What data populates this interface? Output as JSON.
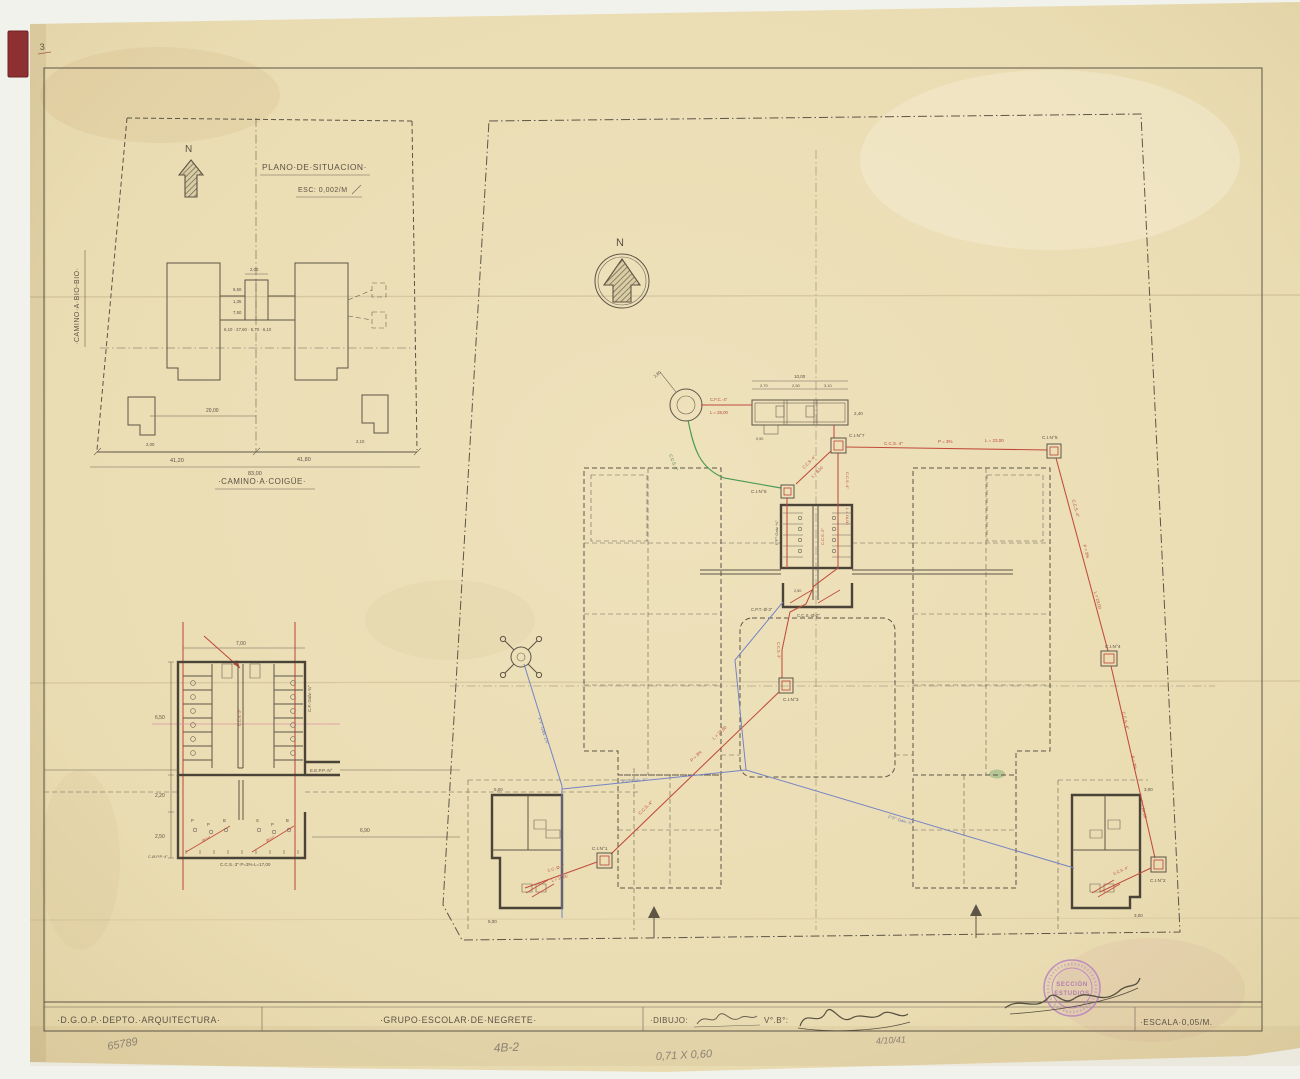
{
  "sheet": {
    "corner_mark": "3",
    "title_block": {
      "department": "·D.G.O.P.·DEPTO.·ARQUITECTURA·",
      "project": "·GRUPO·ESCOLAR·DE·NEGRETE·",
      "drawing_label": "·DIBUJO:",
      "approval_label": "V°.B°:",
      "scale_label": "·ESCALA·0,05/M.",
      "stamp_line1": "SECCIÓN",
      "stamp_line2": "ESTUDIOS"
    },
    "pencil_notes": {
      "code_left": "65789",
      "code_mid": "4B-2",
      "paper_size": "0,71 X 0,60",
      "date": "4/10/41"
    }
  },
  "situation_plan": {
    "title": "PLANO·DE·SITUACION·",
    "scale": "ESC: 0,002/M",
    "north": "N",
    "road_west": "·CAMINO·A·BIO-BIO·",
    "road_south": "·CAMINO·A·COIGÜE·",
    "dims": {
      "d200": "2,00",
      "d650": "6,50",
      "d135": "1,35",
      "d750": "7,50",
      "row": "6,10 · 27,60 · 5,70 · 6,10",
      "d2000": "20,00",
      "d4120": "41,20",
      "d4180": "41,80",
      "d8300": "83,00",
      "d200b": "2,00",
      "d210": "2,10"
    }
  },
  "detail_plan": {
    "dims": {
      "w": "7,00",
      "h1": "6,50",
      "h2": "2,20",
      "h3": "2,50",
      "r": "6,90"
    },
    "labels": {
      "pipe_right": "C.F.·Galv.·¾\"",
      "eepp": "E.E.P.P.·N°",
      "bottom": "C.C.S.·3\"·P=3%·L=17,00",
      "copp": "C.Ø.P.P.·4\"",
      "center_pipe": "C.C.S.·2\"",
      "fx1": "P",
      "fx2": "P",
      "fx3": "B",
      "fx4": "S",
      "fx5": "P",
      "fx6": "B",
      "red1": "Ø1½\"",
      "red2": "Ø1½\""
    }
  },
  "site_plan": {
    "north": "N",
    "chambers": {
      "c1": "C.I.N°1",
      "c2": "C.I.N°2",
      "c3": "C.I.N°3",
      "c4": "C.I.N°4",
      "c5": "C.I.N°5",
      "c6": "C.I.N°6",
      "c7": "C.I.N°7"
    },
    "tank": {
      "w": "10,00",
      "c1": "2,70",
      "c2": "2,50",
      "c3": "3,10",
      "h": "2,40",
      "notch": "0,90",
      "well_dim": "2,80"
    },
    "pipes": {
      "well_tank_a": "C.F.C.·4\"",
      "well_tank_b": "L = 28,00",
      "green": "C.C.S.·2\"",
      "t7_t5_a": "C.C.S.·4\"",
      "t7_t5_b": "P = 3%",
      "t7_t5_c": "L = 23,00",
      "t7_t6_a": "C.C.S.·4\"",
      "t7_t6_b": "L = 8,00",
      "t7_down_a": "C.C.S.·4\"",
      "t7_down_b": "L = 18,00",
      "t5_t4_a": "C.C.S.·4\"",
      "t5_t4_b": "P = 3%",
      "t5_t4_c": "L = 23,00",
      "t4_t2_a": "C.C.S.·4\"",
      "t4_t2_b": "P = 3%",
      "t4_t2_c": "L = 24,00",
      "t3_down": "C.C.S.·3\"",
      "t3_t1_a": "L = 27,00",
      "t3_t1_b": "P = 3%",
      "t3_t1_c": "C.C.S.·4\"",
      "t1_in_a": "C.C.·Ø·4\"",
      "t1_in_b": "L = 10,00",
      "t2_in": "C.C.S.·4\"",
      "blue_a": "F°F°·Galv.·1¼\"",
      "blue_b": "F°F°·Galv.·¾\"",
      "blue_c": "F°F°·Galv.·¾\"",
      "wc_a": "C.P.T.·Ø·3\"",
      "wc_b": "C.C.S.·Ø·2\"",
      "wc_c": "F°F°·Galv.·¾\"",
      "wc_d": "C.C.S.·2\"",
      "wc_dim": "2,50"
    },
    "dims": {
      "left_top": "5,00",
      "left_bottom": "5,00",
      "right_top": "3,00",
      "right_bottom": "3,00"
    }
  }
}
